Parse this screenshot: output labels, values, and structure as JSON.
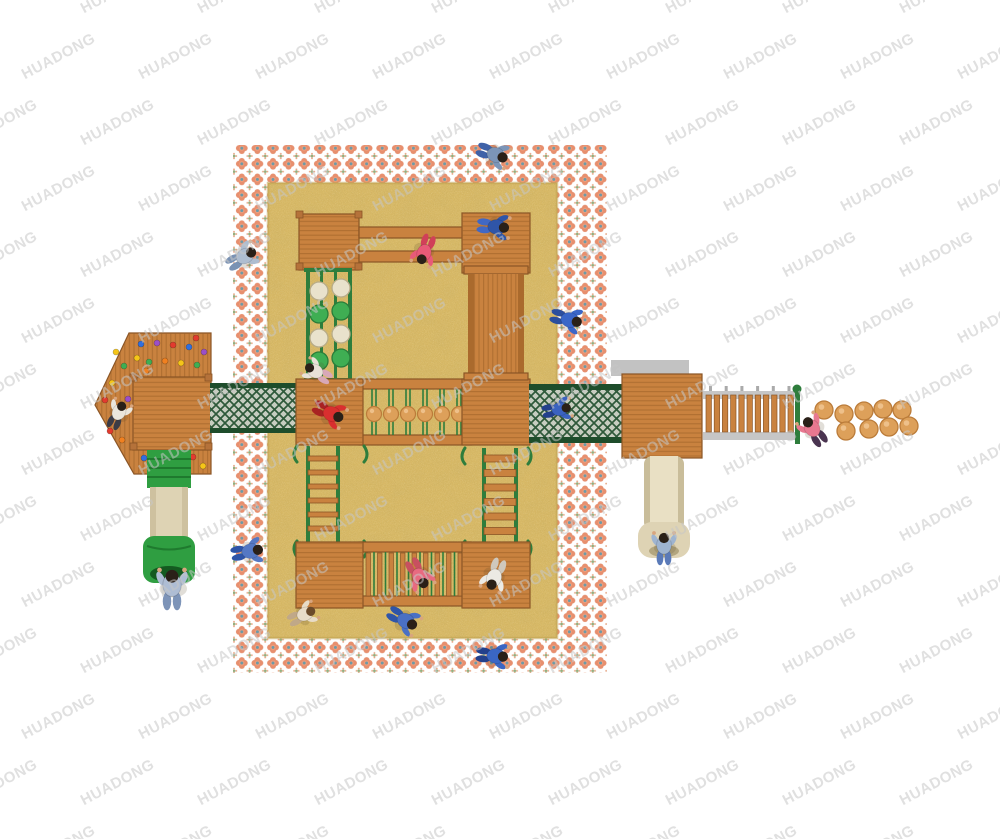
{
  "watermark": {
    "text": "HUADONG"
  },
  "colors": {
    "wood": "#c9823f",
    "woodDark": "#8a5526",
    "woodLine": "#9c6128",
    "woodEdge": "#aa6a2d",
    "woodPost": "#b5723a",
    "greenFrame": "#2e7d3c",
    "netDark": "#1e4d2b",
    "netBg": "#c7cdc0",
    "tubeGreen": "#2f9e41",
    "tubeDark": "#1f7a2e",
    "slideBeige": "#ded3b4",
    "slideShade": "#c9bd9a",
    "slideLight": "#e9e0c4",
    "slideHole": "#b3a67f",
    "sandBase": "#d8b966",
    "sandEdge": "#c2a352",
    "patPetal": "#e78f6e",
    "patPetalLt": "#ef9f7d",
    "patCenter": "#6b9aa8",
    "patLeaf": "#92ae7e",
    "patDot": "#e8a482",
    "graySlab": "#c2c2c2",
    "railGray": "#c6c6c6",
    "discCream": "#e9e2cc",
    "discGreen": "#3fae53",
    "ballFill": "#dda05a",
    "ballEdge": "#bb7c3a",
    "ballHi": "#eec08a",
    "tubeHole": "#145a20",
    "skin": "#d8a57e",
    "hairDefault": "#2a2018"
  },
  "scene": {
    "stepping_balls": [
      {
        "cx": 824,
        "cy": 410
      },
      {
        "cx": 844,
        "cy": 414
      },
      {
        "cx": 864,
        "cy": 411
      },
      {
        "cx": 883,
        "cy": 409
      },
      {
        "cx": 902,
        "cy": 410
      },
      {
        "cx": 846,
        "cy": 431
      },
      {
        "cx": 869,
        "cy": 429
      },
      {
        "cx": 889,
        "cy": 427
      },
      {
        "cx": 909,
        "cy": 426
      }
    ],
    "post_bridge_ball_xs": [
      374,
      391,
      408,
      425,
      442,
      459
    ],
    "discs": [
      {
        "cx": 319,
        "cy": 291,
        "kind": "cream"
      },
      {
        "cx": 319,
        "cy": 314,
        "kind": "green"
      },
      {
        "cx": 319,
        "cy": 338,
        "kind": "cream"
      },
      {
        "cx": 319,
        "cy": 361,
        "kind": "green"
      },
      {
        "cx": 341,
        "cy": 288,
        "kind": "cream"
      },
      {
        "cx": 341,
        "cy": 311,
        "kind": "green"
      },
      {
        "cx": 341,
        "cy": 334,
        "kind": "cream"
      },
      {
        "cx": 341,
        "cy": 358,
        "kind": "green"
      }
    ],
    "holds": [
      {
        "x": 105,
        "y": 400
      },
      {
        "x": 112,
        "y": 383
      },
      {
        "x": 118,
        "y": 417
      },
      {
        "x": 124,
        "y": 366
      },
      {
        "x": 128,
        "y": 399
      },
      {
        "x": 122,
        "y": 440
      },
      {
        "x": 110,
        "y": 431
      },
      {
        "x": 116,
        "y": 352
      },
      {
        "x": 141,
        "y": 344
      },
      {
        "x": 149,
        "y": 362
      },
      {
        "x": 157,
        "y": 343
      },
      {
        "x": 165,
        "y": 361
      },
      {
        "x": 173,
        "y": 345
      },
      {
        "x": 181,
        "y": 363
      },
      {
        "x": 189,
        "y": 347
      },
      {
        "x": 197,
        "y": 365
      },
      {
        "x": 204,
        "y": 352
      },
      {
        "x": 146,
        "y": 371
      },
      {
        "x": 196,
        "y": 338
      },
      {
        "x": 137,
        "y": 358
      },
      {
        "x": 144,
        "y": 458
      },
      {
        "x": 157,
        "y": 466
      },
      {
        "x": 169,
        "y": 457
      },
      {
        "x": 181,
        "y": 465
      },
      {
        "x": 193,
        "y": 457
      },
      {
        "x": 203,
        "y": 466
      }
    ],
    "hold_colors": [
      "#e23b2e",
      "#f5c518",
      "#2f6fe0",
      "#3fae53",
      "#9b4fc8",
      "#f08020"
    ],
    "children": [
      {
        "x": 496,
        "y": 155,
        "rot": 110,
        "shirt": "#7c95b8",
        "pants": "#3f62a8",
        "hair": "#2a2018",
        "scale": 1
      },
      {
        "x": 245,
        "y": 256,
        "rot": 60,
        "shirt": "#aebdd0",
        "pants": "#7a92b4",
        "hair": "#2a2018",
        "scale": 1
      },
      {
        "x": 570,
        "y": 320,
        "rot": 105,
        "shirt": "#3a66c8",
        "pants": "#2c4f9e",
        "hair": "#2a2018",
        "scale": 1
      },
      {
        "x": 497,
        "y": 227,
        "rot": 95,
        "shirt": "#2f55a8",
        "pants": "#4168c4",
        "hair": "#2a2018",
        "scale": 1
      },
      {
        "x": 424,
        "y": 253,
        "rot": 200,
        "shirt": "#e85a78",
        "pants": "#d04058",
        "hair": "#2a2018",
        "scale": 0.95
      },
      {
        "x": 332,
        "y": 414,
        "rot": 115,
        "shirt": "#d92f2f",
        "pants": "#a82222",
        "hair": "#2a2018",
        "scale": 1
      },
      {
        "x": 560,
        "y": 409,
        "rot": 80,
        "shirt": "#3a62c0",
        "pants": "#23408c",
        "hair": "#2a2018",
        "scale": 0.9
      },
      {
        "x": 812,
        "y": 428,
        "rot": -35,
        "shirt": "#e87890",
        "pants": "#4a3450",
        "hair": "#2a2018",
        "scale": 1
      },
      {
        "x": 664,
        "y": 545,
        "rot": 0,
        "shirt": "#9eb4d0",
        "pants": "#5a7ab8",
        "hair": "#2a2018",
        "scale": 1
      },
      {
        "x": 251,
        "y": 551,
        "rot": 80,
        "shirt": "#5578c4",
        "pants": "#2f55a8",
        "hair": "#2a2018",
        "scale": 1
      },
      {
        "x": 315,
        "y": 371,
        "rot": -60,
        "shirt": "#e8e2d8",
        "pants": "#d8a8b8",
        "hair": "#2a2018",
        "scale": 0.9
      },
      {
        "x": 119,
        "y": 412,
        "rot": 25,
        "shirt": "#eae6dc",
        "pants": "#3c3c46",
        "hair": "#2a2018",
        "scale": 0.9
      },
      {
        "x": 172,
        "y": 585,
        "rot": 0,
        "shirt": "#aebdd4",
        "pants": "#7d94b8",
        "hair": "#2a2018",
        "scale": 1.25
      },
      {
        "x": 420,
        "y": 577,
        "rot": 150,
        "shirt": "#e86a80",
        "pants": "#c85060",
        "hair": "#2a2018",
        "scale": 1
      },
      {
        "x": 494,
        "y": 578,
        "rot": 200,
        "shirt": "#eceae4",
        "pants": "#cfc8bc",
        "hair": "#2a2018",
        "scale": 1
      },
      {
        "x": 305,
        "y": 614,
        "rot": 65,
        "shirt": "#e8dcc8",
        "pants": "#c0a888",
        "hair": "#6b4a2a",
        "scale": 0.9
      },
      {
        "x": 406,
        "y": 621,
        "rot": 120,
        "shirt": "#4a70c4",
        "pants": "#2f55a8",
        "hair": "#2a2018",
        "scale": 1
      },
      {
        "x": 496,
        "y": 656,
        "rot": 95,
        "shirt": "#3a66c4",
        "pants": "#23408c",
        "hair": "#2a2018",
        "scale": 1
      }
    ]
  }
}
